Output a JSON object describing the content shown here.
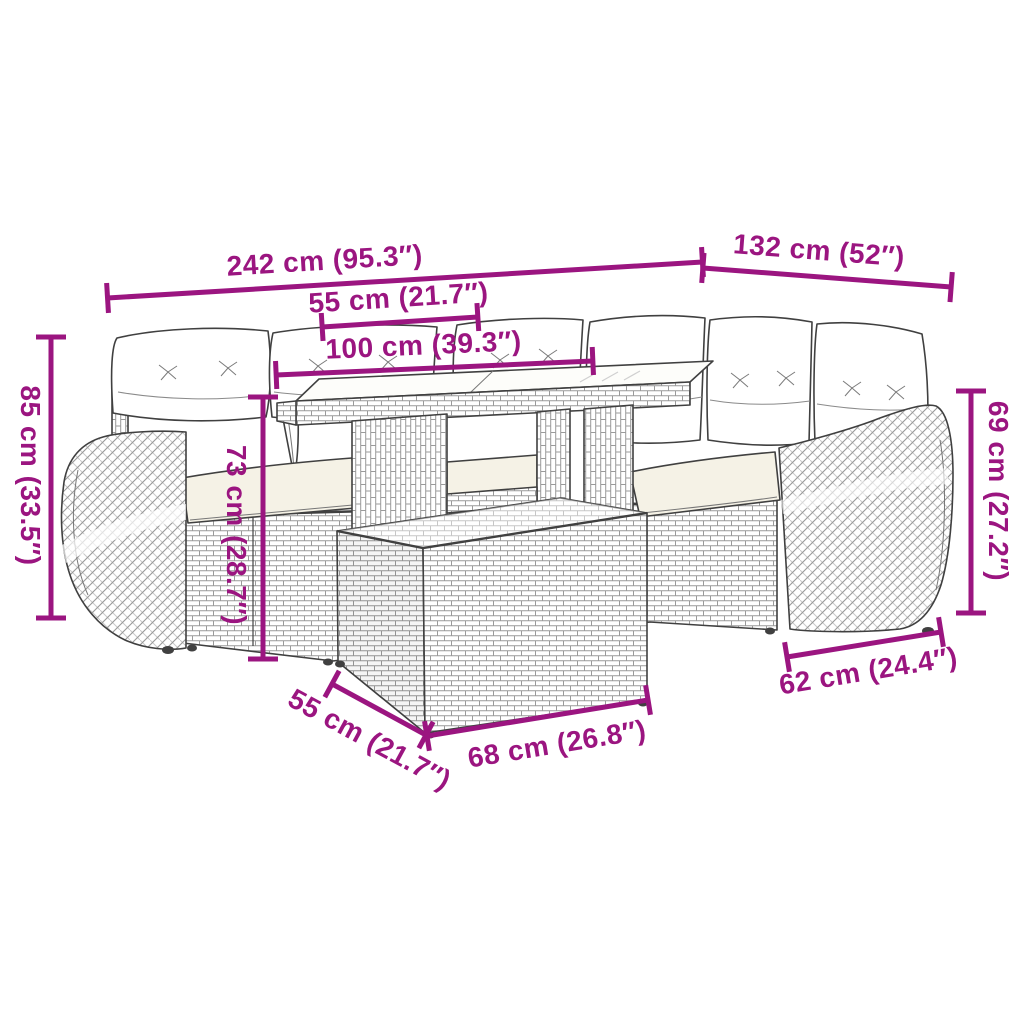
{
  "figure": {
    "kind": "product-dimension-diagram",
    "subject": "rattan-corner-sofa-set-with-table-and-ottoman",
    "background": "#ffffff"
  },
  "colors": {
    "annotation": "#9b1580",
    "line_art": "#404040",
    "weave": "#9a9a9a",
    "cushion_white": "#ffffff",
    "seat_cream": "#f5f2e6"
  },
  "annotations": [
    {
      "id": "overall-width",
      "label": "242 cm (95.3″)"
    },
    {
      "id": "overall-depth",
      "label": "132 cm (52″)"
    },
    {
      "id": "seat-width",
      "label": "55 cm (21.7″)"
    },
    {
      "id": "table-length",
      "label": "100 cm (39.3″)"
    },
    {
      "id": "back-height",
      "label": "85 cm (33.5″)"
    },
    {
      "id": "seat-back-height",
      "label": "73 cm (28.7″)"
    },
    {
      "id": "arm-height",
      "label": "69 cm (27.2″)"
    },
    {
      "id": "side-depth",
      "label": "62 cm (24.4″)"
    },
    {
      "id": "ottoman-depth",
      "label": "55 cm (21.7″)"
    },
    {
      "id": "ottoman-width",
      "label": "68 cm (26.8″)"
    }
  ]
}
